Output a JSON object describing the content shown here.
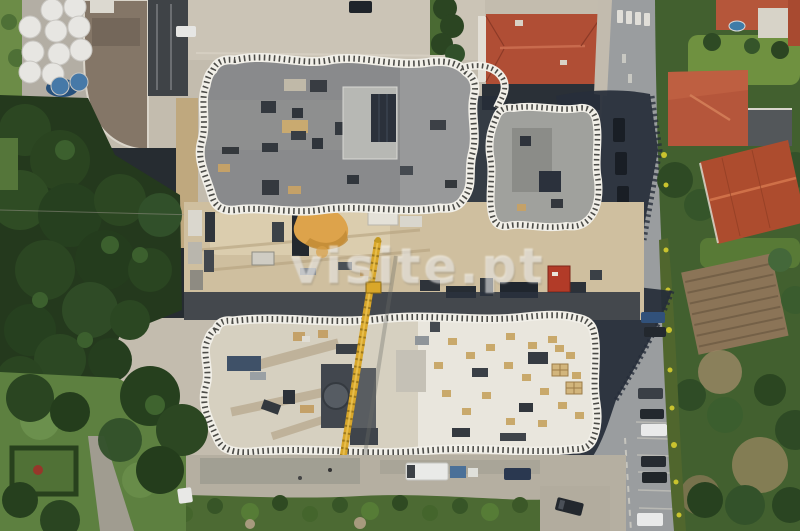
{
  "image": {
    "type": "aerial-drone-photograph",
    "description": "Top-down drone view of a construction site: a finished building with a scalloped white balcony railing (top), a second building under construction on a concrete slab (bottom), a yellow tower crane, a materials yard with a sand pile and red container between them, a road with parked cars and long building shadows on the right, terracotta-roofed houses, hedges and a tilled field to the east, and dense trees with a white patio-umbrella terrace to the west."
  },
  "watermark": {
    "text": "visite.pt",
    "color": "#ffffff",
    "opacity": 0.52
  },
  "palette": {
    "pavement": "#c3bcae",
    "pavement_light": "#cdc6b7",
    "roof_gray": "#8e8f8f",
    "annex_gray": "#a0a19d",
    "railing_white": "#f1efe8",
    "railing_tick": "#4c4c48",
    "slab_tan": "#d6d0c0",
    "slab_light": "#e9e6dd",
    "core_dark": "#42474e",
    "shadow_navy": "#272e3a",
    "road": "#9a9d9f",
    "tree_dark": "#2a4521",
    "grass": "#5d8040",
    "field_brown": "#8b7457",
    "red_roof": "#b04e35",
    "crane_yellow": "#d9a72a",
    "sand": "#dda34b",
    "container_red": "#b23b28",
    "umbrella_white": "#e7e6e2",
    "umbrella_blue": "#4679a8",
    "car_white": "#e9eaea",
    "car_dark": "#23282e",
    "van_white": "#e9eae8"
  },
  "scene": {
    "regions": [
      {
        "name": "completed-building",
        "note": "gray roof, wavy white balcony railing"
      },
      {
        "name": "annex-building",
        "note": "smaller wing with same railing"
      },
      {
        "name": "construction-yard",
        "note": "sand pile, formwork stacks, red container, machinery"
      },
      {
        "name": "building-under-construction",
        "note": "concrete slab, pallets, dark service core"
      },
      {
        "name": "tower-crane",
        "note": "yellow lattice boom crossing the site"
      },
      {
        "name": "road-east",
        "note": "parked cars, crosswalk, building shadows"
      },
      {
        "name": "houses-east",
        "note": "terracotta roofs, tilled field, flowering hedge"
      },
      {
        "name": "trees-west",
        "note": "dense canopy beside umbrella terrace and pool"
      },
      {
        "name": "lawn-southwest",
        "note": "garden plot, footpath, parked white car"
      },
      {
        "name": "service-lane-south",
        "note": "white van, cars, scrub vegetation strip"
      }
    ]
  }
}
